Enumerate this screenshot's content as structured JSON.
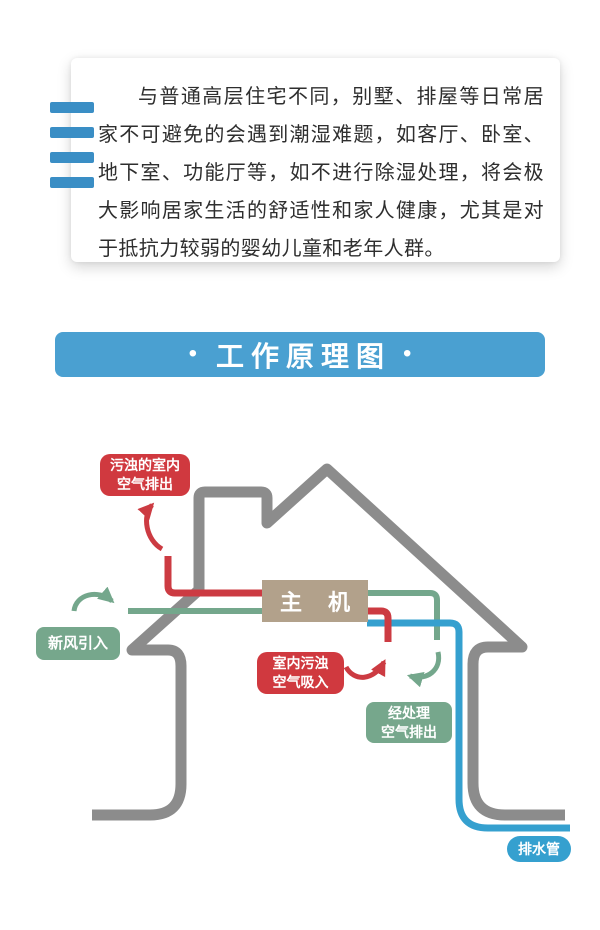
{
  "intro_card": {
    "text": "与普通高层住宅不同，别墅、排屋等日常居家不可避免的会遇到潮湿难题，如客厅、卧室、地下室、功能厅等，如不进行除湿处理，将会极大影响居家生活的舒适性和家人健康，尤其是对于抵抗力较弱的婴幼儿童和老年人群。",
    "accent_bar_color": "#3a8ec5"
  },
  "banner": {
    "bullet_left": "•",
    "title": "工作原理图",
    "bullet_right": "•",
    "bg_color": "#4aa0d1"
  },
  "diagram": {
    "main_unit_label": "主 机",
    "labels": {
      "dirty_air_out": [
        "污浊的室内",
        "空气排出"
      ],
      "fresh_air_in": "新风引入",
      "indoor_dirty_in": [
        "室内污浊",
        "空气吸入"
      ],
      "treated_air_out": [
        "经处理",
        "空气排出"
      ],
      "drain_pipe": "排水管"
    },
    "colors": {
      "house_gray": "#8c8c8c",
      "exhaust_red": "#cc3b42",
      "fresh_green": "#74a78c",
      "drain_blue": "#35a0cf",
      "unit_tan": "#b2a18b",
      "label_red": "#d0393f",
      "label_green": "#76a78c"
    }
  }
}
